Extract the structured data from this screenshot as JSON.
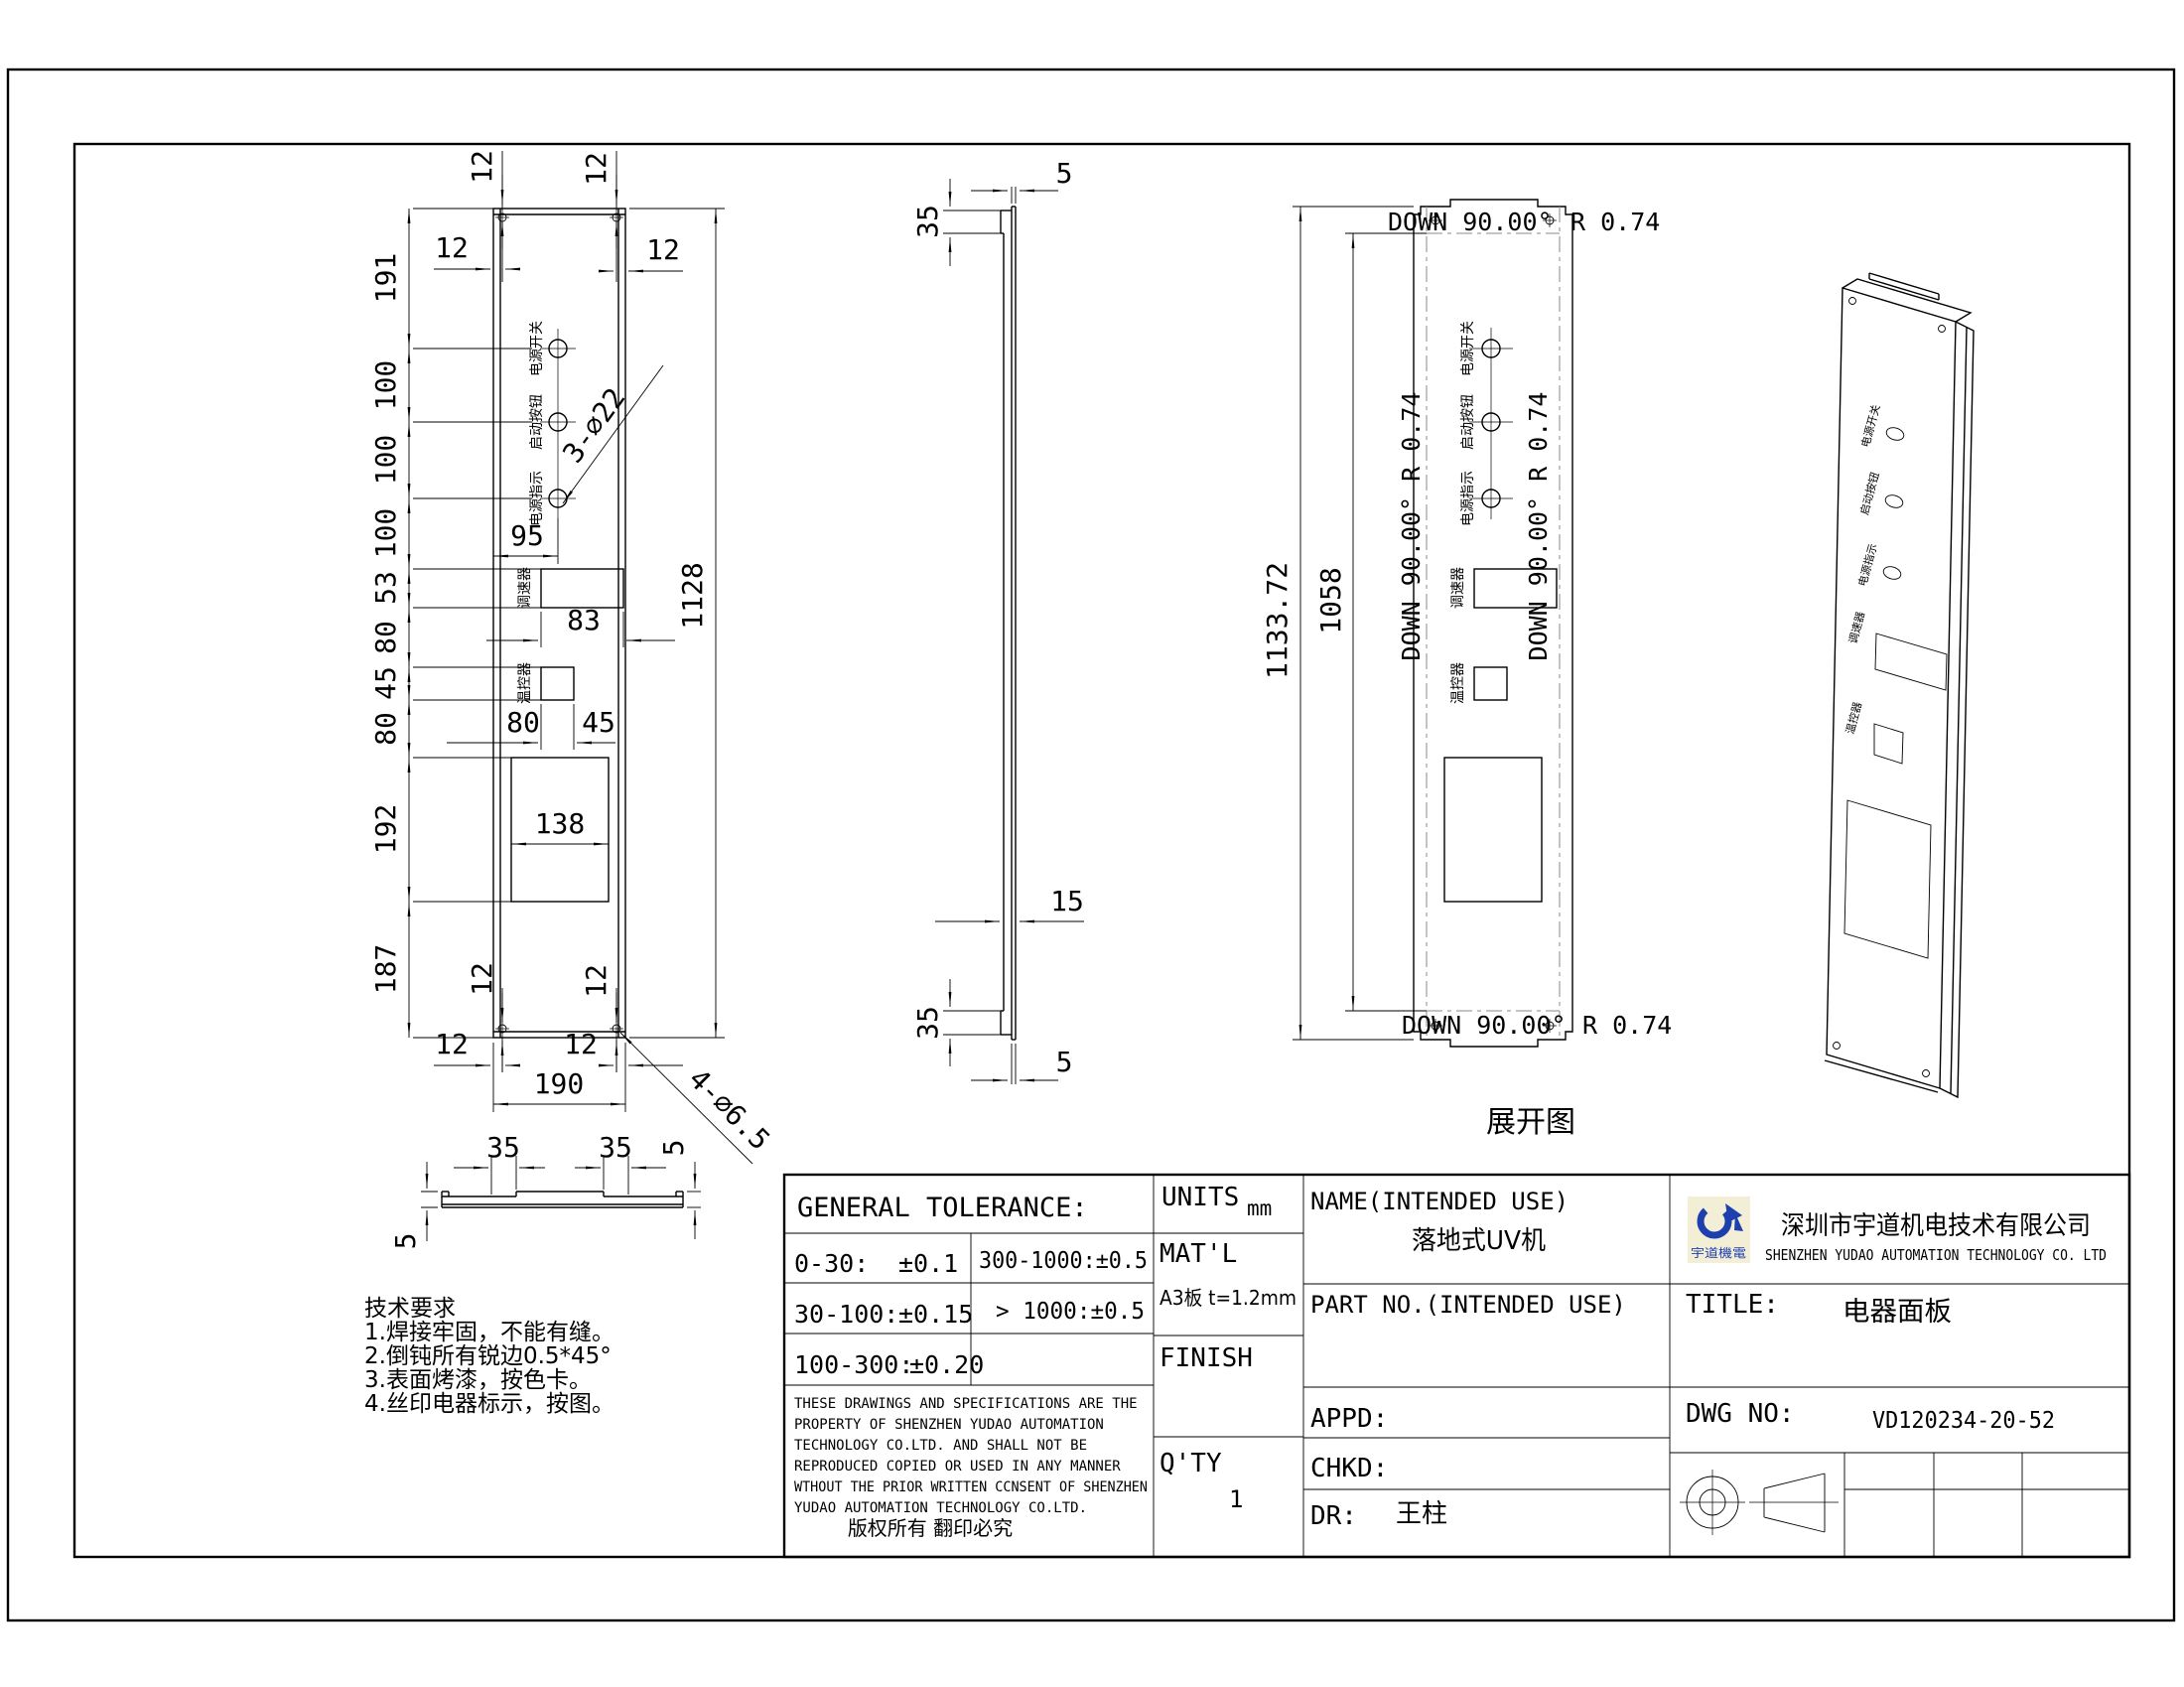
{
  "front": {
    "labels": {
      "power_switch": "电源开关",
      "start_button": "启动按钮",
      "power_indicator": "电源指示",
      "speed_controller": "调速器",
      "temp_controller": "温控器"
    },
    "dims": {
      "d12": "12",
      "d191": "191",
      "d100": "100",
      "d95": "95",
      "d53": "53",
      "d83": "83",
      "d80": "80",
      "d45": "45",
      "d138": "138",
      "d192": "192",
      "d187": "187",
      "d190": "190",
      "d1128": "1128",
      "note3": "3-∅22",
      "note4": "4-∅6.5"
    }
  },
  "bottom": {
    "d35": "35",
    "d5": "5"
  },
  "side": {
    "d35": "35",
    "d5": "5",
    "d15": "15"
  },
  "flat": {
    "d1133": "1133.72",
    "d1058": "1058",
    "bend": "DOWN  90.00°",
    "radius": "R 0.74",
    "bend_side": "DOWN  90.00°  R 0.74",
    "caption": "展开图"
  },
  "tech": {
    "title": "技术要求",
    "items": [
      "1.焊接牢固，不能有缝。",
      "2.倒钝所有锐边0.5*45°",
      "3.表面烤漆，按色卡。",
      "4.丝印电器标示，按图。"
    ]
  },
  "tb": {
    "general_heading": "GENERAL TOLERANCE:",
    "tol": [
      {
        "r": "0-30:",
        "v": "±0.1",
        "r2": "300-1000:±0.5"
      },
      {
        "r": "30-100:",
        "v": "±0.15",
        "r2": "> 1000:±0.5"
      },
      {
        "r": "100-300:",
        "v": "±0.20",
        "r2": ""
      }
    ],
    "units_label": "UNITS",
    "units_value": "mm",
    "matl_label": "MAT'L",
    "matl_value": "A3板 t=1.2mm",
    "finish_label": "FINISH",
    "qty_label": "Q'TY",
    "qty_value": "1",
    "name_label": "NAME(INTENDED USE)",
    "name_value": "落地式UV机",
    "part_label": "PART NO.(INTENDED USE)",
    "appd_label": "APPD:",
    "chkd_label": "CHKD:",
    "dr_label": "DR:",
    "dr_value": "王柱",
    "company_cn": "深圳市宇道机电技术有限公司",
    "company_en": "SHENZHEN YUDAO AUTOMATION TECHNOLOGY CO. LTD",
    "logo_text": "宇道機電",
    "title_label": "TITLE:",
    "title_value": "电器面板",
    "dwg_label": "DWG NO:",
    "dwg_value": "VD120234-20-52",
    "disclaimer": [
      "THESE DRAWINGS AND SPECIFICATIONS ARE THE",
      "PROPERTY OF SHENZHEN YUDAO AUTOMATION",
      "TECHNOLOGY CO.LTD.  AND SHALL NOT BE",
      "REPRODUCED COPIED OR USED IN ANY MANNER",
      "WTHOUT THE PRIOR WRITTEN CCNSENT OF SHENZHEN",
      "YUDAO AUTOMATION TECHNOLOGY CO.LTD.",
      "版权所有  翻印必究"
    ]
  }
}
